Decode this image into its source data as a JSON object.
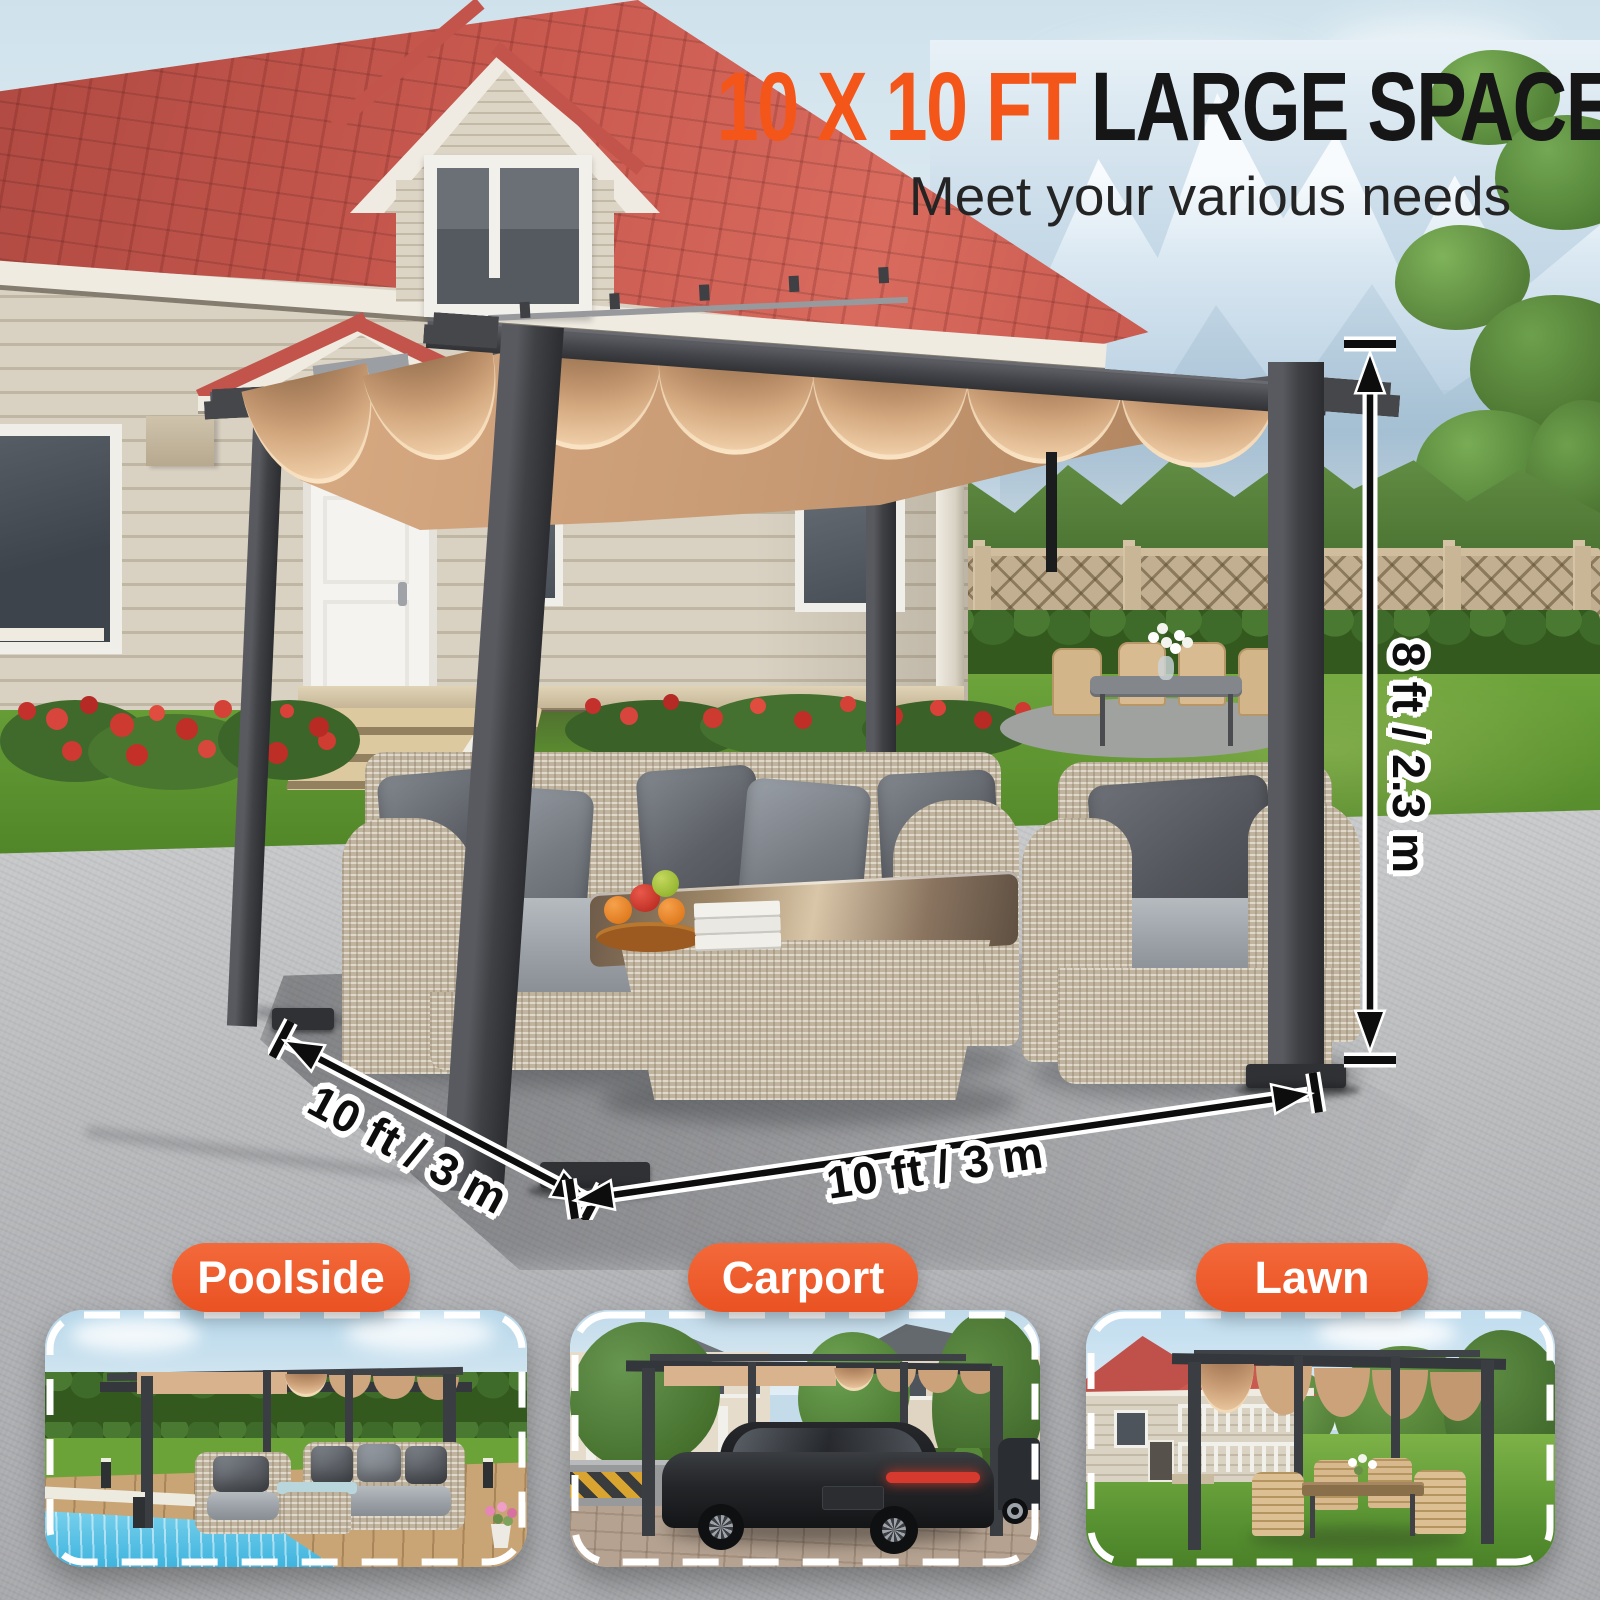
{
  "header": {
    "title_accent": "10 X 10 FT",
    "title_main": "LARGE SPACE",
    "subtitle": "Meet your various needs"
  },
  "dimensions": {
    "height": "8 ft / 2.3 m",
    "depth": "10 ft / 3 m",
    "width": "10 ft / 3 m"
  },
  "use_cases": [
    {
      "label": "Poolside"
    },
    {
      "label": "Carport"
    },
    {
      "label": "Lawn"
    }
  ],
  "colors": {
    "accent_orange": "#F4561A",
    "pill_orange": "#EE5A28",
    "canopy_beige": "#D3A67F",
    "frame_charcoal": "#3F4044",
    "roof_red": "#C3544B",
    "dimension_line_black": "#0D0D0D",
    "dimension_outline_white": "#FFFFFF"
  }
}
